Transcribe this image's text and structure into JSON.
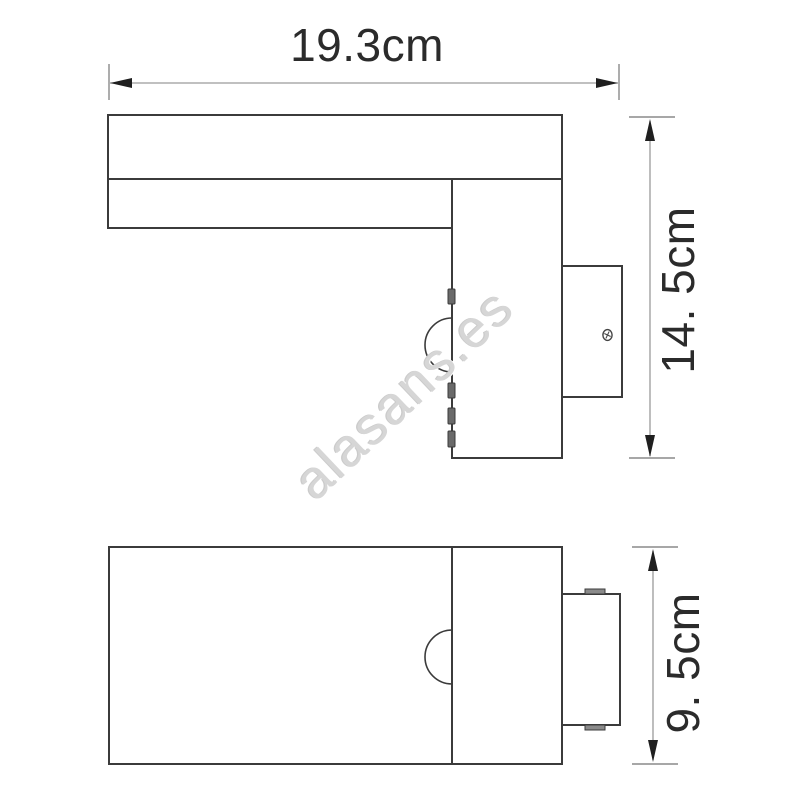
{
  "watermark": {
    "text": "alasans.es",
    "color": "#d6d6d6",
    "rotation_deg": -43.5
  },
  "dimensions": {
    "width": {
      "label": "19.3cm",
      "value_cm": 19.3,
      "unit": "cm"
    },
    "height": {
      "label": "14. 5cm",
      "value_cm": 14.5,
      "unit": "cm"
    },
    "depth": {
      "label": "9. 5cm",
      "value_cm": 9.5,
      "unit": "cm"
    }
  },
  "colors": {
    "background": "#ffffff",
    "outline": "#3b3b3b",
    "dimension_line": "#9a9a9a",
    "dimension_tick": "#8a8a8a",
    "arrow": "#1f1f1f",
    "label_text": "#2b2b2b",
    "tab_fill": "#6a6a6a",
    "watermark": "#d6d6d6"
  }
}
